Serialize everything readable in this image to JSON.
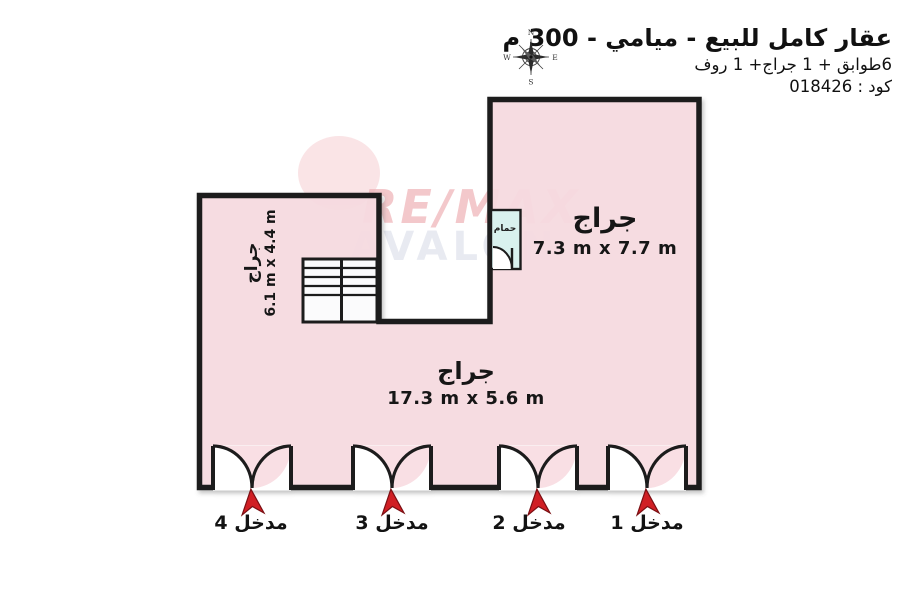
{
  "header": {
    "title": "عقار كامل للبيع - ميامي - 300 م",
    "subtitle": "6طوابق + 1 جراج+ 1 روف",
    "code_label": "كود : 018426",
    "compass": {
      "north": "N",
      "east": "E",
      "south": "S",
      "west": "W"
    }
  },
  "watermark": {
    "line1": "RE/MAX",
    "line2": "AVALON"
  },
  "plan": {
    "rooms": [
      {
        "id": "garage-top-right",
        "name": "جراج",
        "dimensions": "7.3 m x 7.7 m"
      },
      {
        "id": "garage-left",
        "name": "جراج",
        "dimensions": "6.1 m x 4.4 m"
      },
      {
        "id": "garage-bottom",
        "name": "جراج",
        "dimensions": "17.3 m x 5.6 m"
      },
      {
        "id": "bathroom",
        "name": "حمام"
      }
    ],
    "entrances": [
      {
        "label": "مدخل 1"
      },
      {
        "label": "مدخل 2"
      },
      {
        "label": "مدخل 3"
      },
      {
        "label": "مدخل 4"
      }
    ],
    "colors": {
      "room_fill": "#f8dce2",
      "wall": "#1a1a1a",
      "bathroom_fill": "#d9f1ee",
      "stair_fill": "#fbfbfc",
      "arrow_red": "#d01f24",
      "arrow_outline": "#7a0f13",
      "watermark_red": "#efb6ba",
      "watermark_gray": "#e7e9f1"
    }
  }
}
